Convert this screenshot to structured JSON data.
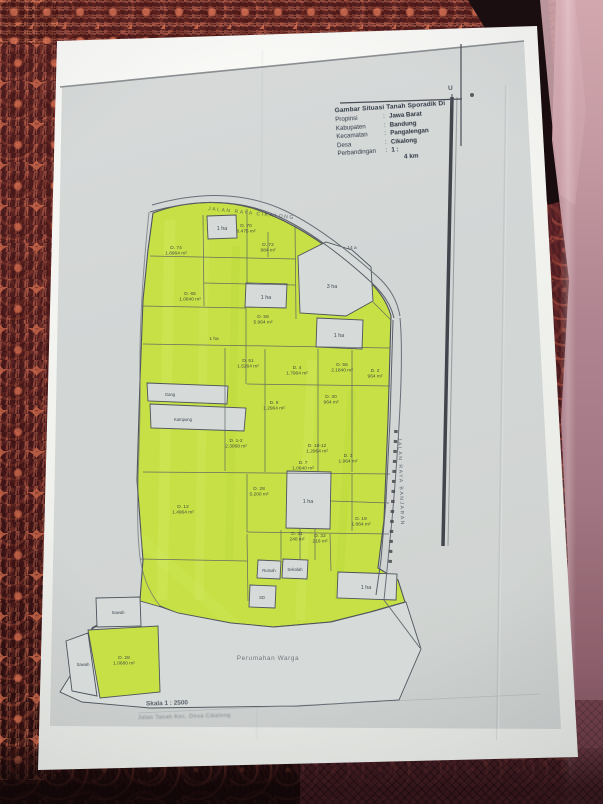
{
  "photo": {
    "surface": "patterned maroon fabric with pink satin fold on right",
    "colors": {
      "highlight_green": "#c6e045",
      "paper": "#f1f2ee",
      "photocopy_gray": "#d2d6d5",
      "fabric_maroon": "#5a2328",
      "fabric_pink": "#b98f98",
      "ink": "#2e3440"
    }
  },
  "title_block": {
    "header": "Gambar Situasi Tanah Sporadik Di",
    "rows": [
      {
        "label": "Propinsi",
        "value": "Jawa Barat"
      },
      {
        "label": "Kabupaten",
        "value": "Bandung"
      },
      {
        "label": "Kecamatan",
        "value": "Pangalengan"
      },
      {
        "label": "Desa",
        "value": "Cikalong"
      },
      {
        "label": "Perbandingan",
        "value": "1 :"
      }
    ],
    "scale_note": "4 km"
  },
  "north_mark": "U",
  "roads": [
    {
      "name": "JALAN RAYA CIKALONG",
      "orientation": "top-curve"
    },
    {
      "name": "JALAN RAYA BANJARAN",
      "orientation": "right-vertical"
    }
  ],
  "notes": [
    {
      "text": "Skala 1 : 2500"
    },
    {
      "text": "Jalan Tanah Kec. Desa Cikalong"
    }
  ],
  "map": {
    "parcels": [
      {
        "type": "white",
        "label": "Perumahan Warga",
        "size": "xl",
        "lx": 268,
        "ly": 660,
        "points": "60,692 80,660 92,629 140,601 161,607 178,613 231,623 274,627 331,622 371,612 406,602 421,649 399,700 298,706 150,708 82,702"
      },
      {
        "type": "green",
        "label": "",
        "lx": 0,
        "ly": 0,
        "points": "88,630 158,626 160,692 100,698"
      },
      {
        "type": "white",
        "label": "Sawah",
        "size": "s",
        "lx": 118,
        "ly": 614,
        "points": "96,598 140,597 141,626 97,627"
      },
      {
        "type": "white",
        "label": "Sawah",
        "size": "s",
        "lx": 83,
        "ly": 666,
        "points": "66,641 88,633 97,696 72,691"
      },
      {
        "type": "white",
        "label": "1 ha",
        "lx": 222,
        "ly": 230,
        "points": "207,216 236,215 237,238 208,239"
      },
      {
        "type": "white",
        "label": "3 ha",
        "lx": 332,
        "ly": 288,
        "points": "298,256 326,242 352,250 371,267 373,301 346,316 300,313"
      },
      {
        "type": "white",
        "label": "1 ha",
        "lx": 266,
        "ly": 299,
        "points": "246,283 287,284 286,308 245,307"
      },
      {
        "type": "white",
        "label": "1 ha",
        "lx": 339,
        "ly": 337,
        "points": "317,318 363,320 362,349 316,347"
      },
      {
        "type": "white",
        "label": "1 ha",
        "lx": 308,
        "ly": 503,
        "points": "287,471 331,472 330,529 286,528"
      },
      {
        "type": "white",
        "label": "Gang",
        "size": "s",
        "lx": 170,
        "ly": 396,
        "points": "147,383 228,386 227,404 148,401"
      },
      {
        "type": "white",
        "label": "Kampung",
        "size": "s",
        "lx": 183,
        "ly": 421,
        "points": "150,404 246,408 244,431 151,428"
      },
      {
        "type": "white",
        "label": "1 ha",
        "lx": 366,
        "ly": 589,
        "points": "338,572 397,574 396,600 337,598"
      },
      {
        "type": "white",
        "label": "Rumah",
        "size": "s",
        "lx": 269,
        "ly": 572,
        "points": "258,560 281,561 280,579 257,578"
      },
      {
        "type": "white",
        "label": "Sekolah",
        "size": "s",
        "lx": 295,
        "ly": 571,
        "points": "283,559 308,560 307,579 282,578"
      },
      {
        "type": "white",
        "label": "SD",
        "size": "s",
        "lx": 262,
        "ly": 599,
        "points": "250,585 276,586 275,608 249,607"
      }
    ],
    "green_labels": [
      {
        "id": "D. 74",
        "area": "1.8964 m²",
        "x": 176,
        "y": 249
      },
      {
        "id": "D. 70",
        "area": "8.475 m²",
        "x": 246,
        "y": 227
      },
      {
        "id": "D. 72",
        "area": "984 m²",
        "x": 268,
        "y": 246
      },
      {
        "id": "14 a",
        "area": "",
        "x": 352,
        "y": 249
      },
      {
        "id": "D. 65",
        "area": "1.0640 m²",
        "x": 190,
        "y": 295
      },
      {
        "id": "D. 58",
        "area": "5.964 m²",
        "x": 263,
        "y": 318
      },
      {
        "id": "1 ha",
        "area": "",
        "x": 214,
        "y": 340
      },
      {
        "id": "D. 51",
        "area": "1.5264 m²",
        "x": 248,
        "y": 362
      },
      {
        "id": "D. 4",
        "area": "1.7964 m²",
        "x": 297,
        "y": 369
      },
      {
        "id": "D. 55",
        "area": "2.1840 m²",
        "x": 342,
        "y": 366
      },
      {
        "id": "D. 2",
        "area": "964 m²",
        "x": 375,
        "y": 372
      },
      {
        "id": "D. 9",
        "area": "1.2964 m²",
        "x": 274,
        "y": 404
      },
      {
        "id": "D. 30",
        "area": "964 m²",
        "x": 331,
        "y": 398
      },
      {
        "id": "D. 1-2",
        "area": "2.3068 m²",
        "x": 236,
        "y": 442
      },
      {
        "id": "D. 10-12",
        "area": "1.2964 m²",
        "x": 317,
        "y": 447
      },
      {
        "id": "D. 7",
        "area": "1.0640 m²",
        "x": 303,
        "y": 464
      },
      {
        "id": "D. 3",
        "area": "1.964 m²",
        "x": 348,
        "y": 457
      },
      {
        "id": "D. 28",
        "area": "5.200 m²",
        "x": 259,
        "y": 490
      },
      {
        "id": "D. 12",
        "area": "1.4964 m²",
        "x": 183,
        "y": 508
      },
      {
        "id": "D. 31",
        "area": "240 m²",
        "x": 297,
        "y": 535
      },
      {
        "id": "D. 32",
        "area": "216 m²",
        "x": 320,
        "y": 537
      },
      {
        "id": "D. 19",
        "area": "1.864 m²",
        "x": 361,
        "y": 520
      },
      {
        "id": "D. 28",
        "area": "1.0680 m²",
        "x": 124,
        "y": 659
      }
    ]
  }
}
